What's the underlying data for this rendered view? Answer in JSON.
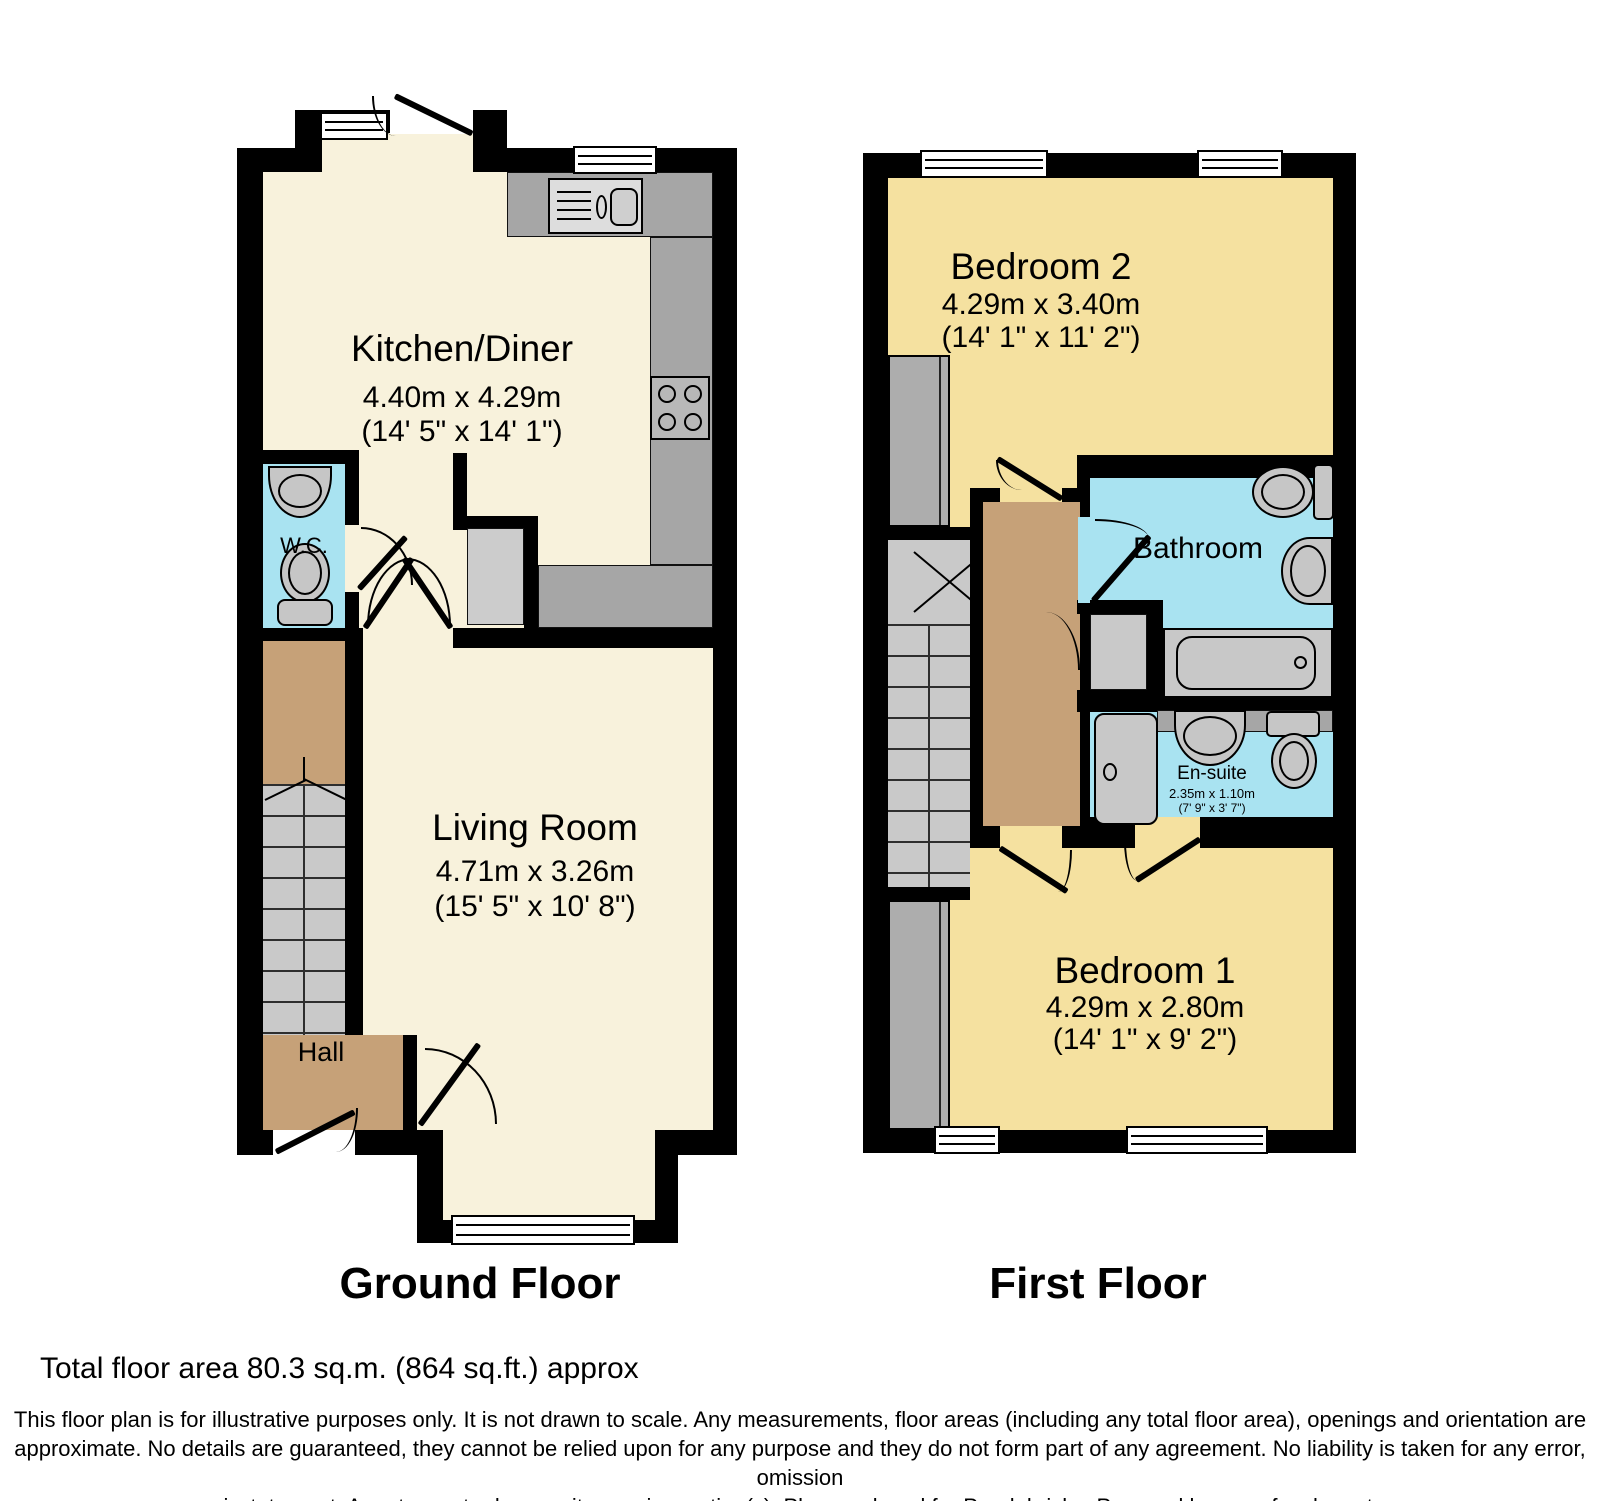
{
  "ground_floor": {
    "label": "Ground Floor",
    "rooms": {
      "kitchen": {
        "name": "Kitchen/Diner",
        "dim_metric": "4.40m x 4.29m",
        "dim_imperial": "(14' 5\" x 14' 1\")"
      },
      "wc": {
        "name": "W.C."
      },
      "living": {
        "name": "Living Room",
        "dim_metric": "4.71m x 3.26m",
        "dim_imperial": "(15' 5\" x 10' 8\")"
      },
      "hall": {
        "name": "Hall"
      }
    }
  },
  "first_floor": {
    "label": "First Floor",
    "rooms": {
      "bedroom2": {
        "name": "Bedroom 2",
        "dim_metric": "4.29m x 3.40m",
        "dim_imperial": "(14' 1\" x 11' 2\")"
      },
      "bathroom": {
        "name": "Bathroom"
      },
      "ensuite": {
        "name": "En-suite",
        "dim_metric": "2.35m x 1.10m",
        "dim_imperial": "(7' 9\" x 3' 7\")"
      },
      "bedroom1": {
        "name": "Bedroom 1",
        "dim_metric": "4.29m x 2.80m",
        "dim_imperial": "(14' 1\" x 9' 2\")"
      }
    }
  },
  "footer": {
    "total_area": "Total floor area 80.3 sq.m. (864 sq.ft.) approx",
    "disclaimer_lines": [
      "This floor plan is for illustrative purposes only. It is not drawn to scale. Any measurements, floor areas (including any total floor area), openings and orientation are",
      "approximate. No details are guaranteed, they cannot be relied upon for any purpose and they do not form part of any agreement. No liability is taken for any error, omission",
      "or misstatement. A party must rely upon its own inspection(s). Plan produced for Purplebricks. Powered by www.focalagent.com"
    ]
  },
  "colors": {
    "wall": "#000000",
    "ground_floor_room": "#F8F2DC",
    "bedroom": "#F5E1A0",
    "hall_landing": "#C6A178",
    "wet_room": "#A9E3F1",
    "counter": "#A6A6A6",
    "fixture": "#C6C6C6"
  },
  "fixtures": {
    "ground_floor": [
      "kitchen-sink",
      "hob",
      "wc-basin",
      "wc-toilet",
      "stairs",
      "windows",
      "doors"
    ],
    "first_floor": [
      "bath",
      "bathroom-toilet",
      "bathroom-basin",
      "shower",
      "ensuite-basin",
      "ensuite-toilet",
      "wardrobes",
      "stairs",
      "windows",
      "doors"
    ]
  }
}
